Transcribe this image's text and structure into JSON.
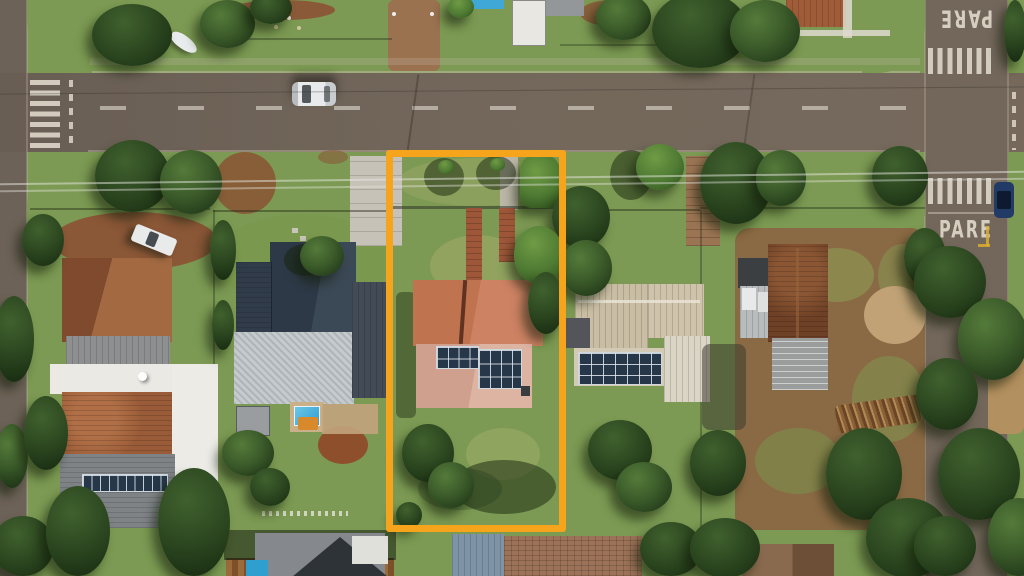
{
  "scene": {
    "description": "Top-down aerial drone photo of a suburban residential block; one property lot is outlined with an orange boundary rectangle",
    "annotation": {
      "type": "lot-boundary-rectangle",
      "color": "#F6A41C"
    },
    "road_markings": {
      "stop_text_top": "PARE",
      "stop_text_bottom": "PARE"
    },
    "objects": {
      "vehicles": [
        "white car driving on main road",
        "white pickup parked in dirt yard",
        "dark blue car parked on side street",
        "small white boat on front lawn"
      ],
      "features": [
        "zebra crosswalks",
        "solar panel arrays on three roofs",
        "backyard swimming pool",
        "terracotta tile roofs",
        "power lines along street"
      ]
    },
    "colors": {
      "asphalt": "#6F6459",
      "grass": "#7C9A53",
      "highlight": "#F6A41C",
      "terracotta_roof": "#C4765A",
      "navy_roof": "#2E3947",
      "beige_roof": "#C9BDA3",
      "rusty_roof": "#6E4026",
      "solar_panel": "#26374A",
      "pool_water": "#2F9FD0"
    }
  }
}
